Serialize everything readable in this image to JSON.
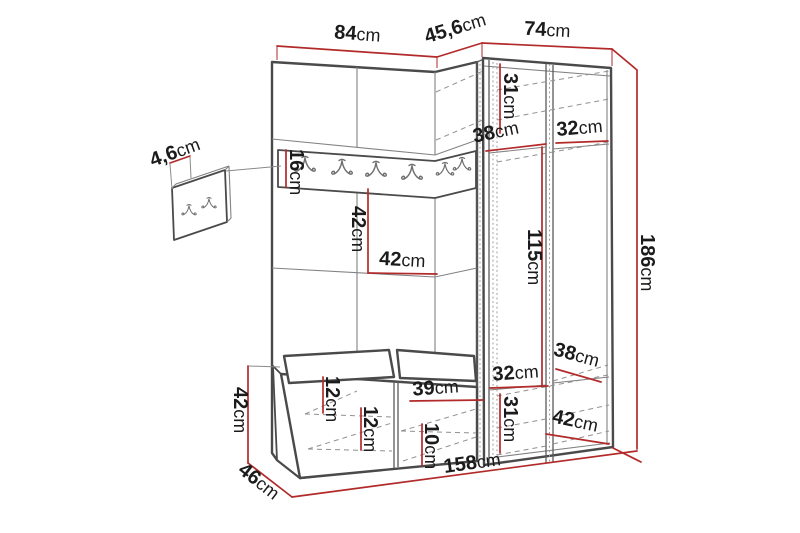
{
  "diagram": {
    "type": "furniture_dimension_diagram",
    "unit": "cm",
    "colors": {
      "dimension_line": "#b22a2a",
      "outline": "#4a4a4a",
      "background": "#ffffff",
      "label_text": "#1b1b1b"
    },
    "hooks": {
      "rail_hook_count": 6,
      "wall_panel_hook_count": 2
    },
    "dimensions": {
      "top_width_left": {
        "value": "84",
        "unit": "cm"
      },
      "top_width_corner": {
        "value": "45,6",
        "unit": "cm"
      },
      "top_width_right": {
        "value": "74",
        "unit": "cm"
      },
      "wall_panel_thickness": {
        "value": "4,6",
        "unit": "cm"
      },
      "hook_rail_height": {
        "value": "16",
        "unit": "cm"
      },
      "open_compartment_height": {
        "value": "42",
        "unit": "cm"
      },
      "open_compartment_width": {
        "value": "42",
        "unit": "cm"
      },
      "wardrobe_top_compartment_height": {
        "value": "31",
        "unit": "cm"
      },
      "wardrobe_top_shelf_depth": {
        "value": "38",
        "unit": "cm"
      },
      "wardrobe_top_shelf_width": {
        "value": "32",
        "unit": "cm"
      },
      "wardrobe_hanging_height": {
        "value": "115",
        "unit": "cm"
      },
      "total_height": {
        "value": "186",
        "unit": "cm"
      },
      "wardrobe_bottom_shelf_depth": {
        "value": "38",
        "unit": "cm"
      },
      "wardrobe_bottom_shelf_width": {
        "value": "32",
        "unit": "cm"
      },
      "wardrobe_bottom_compartment_height": {
        "value": "31",
        "unit": "cm"
      },
      "wardrobe_bottom_depth": {
        "value": "42",
        "unit": "cm"
      },
      "bench_height": {
        "value": "42",
        "unit": "cm"
      },
      "bench_depth": {
        "value": "46",
        "unit": "cm"
      },
      "total_width": {
        "value": "158",
        "unit": "cm"
      },
      "bench_upper_shelf_spacing": {
        "value": "12",
        "unit": "cm"
      },
      "bench_lower_shelf_spacing": {
        "value": "12",
        "unit": "cm"
      },
      "bench_right_compartment_width": {
        "value": "39",
        "unit": "cm"
      },
      "bench_shoe_shelf_spacing": {
        "value": "10",
        "unit": "cm"
      }
    }
  }
}
